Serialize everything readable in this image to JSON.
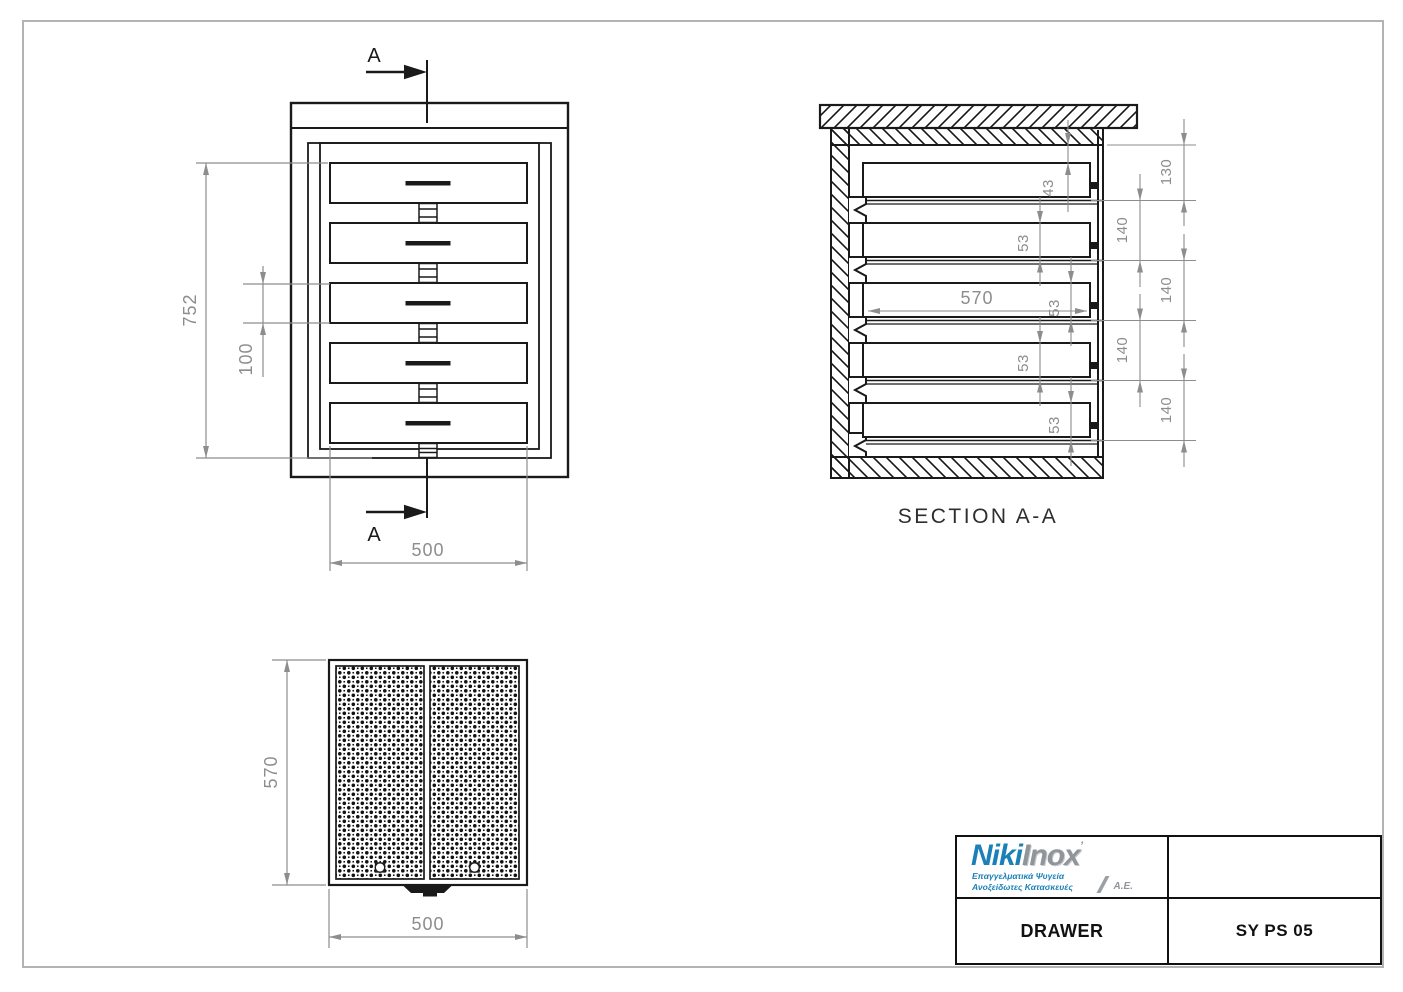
{
  "colors": {
    "line": "#1a1a1a",
    "dimension": "#8d8d8d",
    "logo_blue": "#1b80b6",
    "logo_silver": "#8f959b"
  },
  "front_view": {
    "section_letter": "A",
    "dim_height": "752",
    "dim_drawer_front": "100",
    "dim_width": "500"
  },
  "section_view": {
    "title": "SECTION A-A",
    "dim_depth": "570",
    "dim_top_gap": "43",
    "drawer_heights": [
      "53",
      "53",
      "53",
      "53"
    ],
    "pitches": [
      "130",
      "140",
      "140",
      "140",
      "140"
    ]
  },
  "top_view": {
    "dim_depth": "570",
    "dim_width": "500"
  },
  "title_block": {
    "part_name": "DRAWER",
    "part_code": "SY PS 05",
    "logo": {
      "niki": "Niki",
      "inox": "Inox",
      "mark": "’",
      "subtitle1": "Επαγγελματικά Ψυγεία",
      "subtitle2": "Ανοξείδωτες Κατασκευές",
      "suffix": "Α.Ε."
    }
  }
}
